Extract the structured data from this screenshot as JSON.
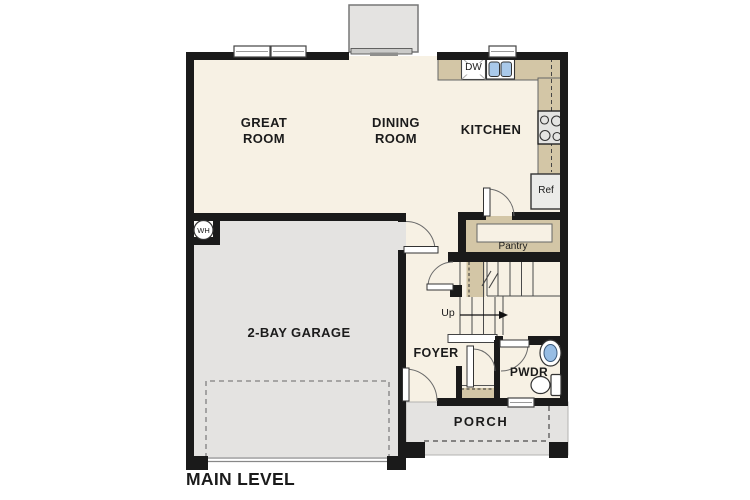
{
  "level": {
    "title": "MAIN LEVEL"
  },
  "rooms": {
    "great_room": "GREAT ROOM",
    "dining_room": "DINING ROOM",
    "kitchen": "KITCHEN",
    "garage": "2-BAY GARAGE",
    "foyer": "FOYER",
    "powder_room": "PWDR",
    "porch": "PORCH",
    "pantry": "Pantry"
  },
  "annotations": {
    "stairs_direction": "Up",
    "dishwasher": "DW",
    "refrigerator": "Ref",
    "water_heater": "WH"
  },
  "colors": {
    "wall": "#1a1a1a",
    "room": "#f7f1e4",
    "gray": "#e4e3e1",
    "tan": "#d3c6a6",
    "blue": "#a9c9ea",
    "blue2": "#97bde4"
  }
}
